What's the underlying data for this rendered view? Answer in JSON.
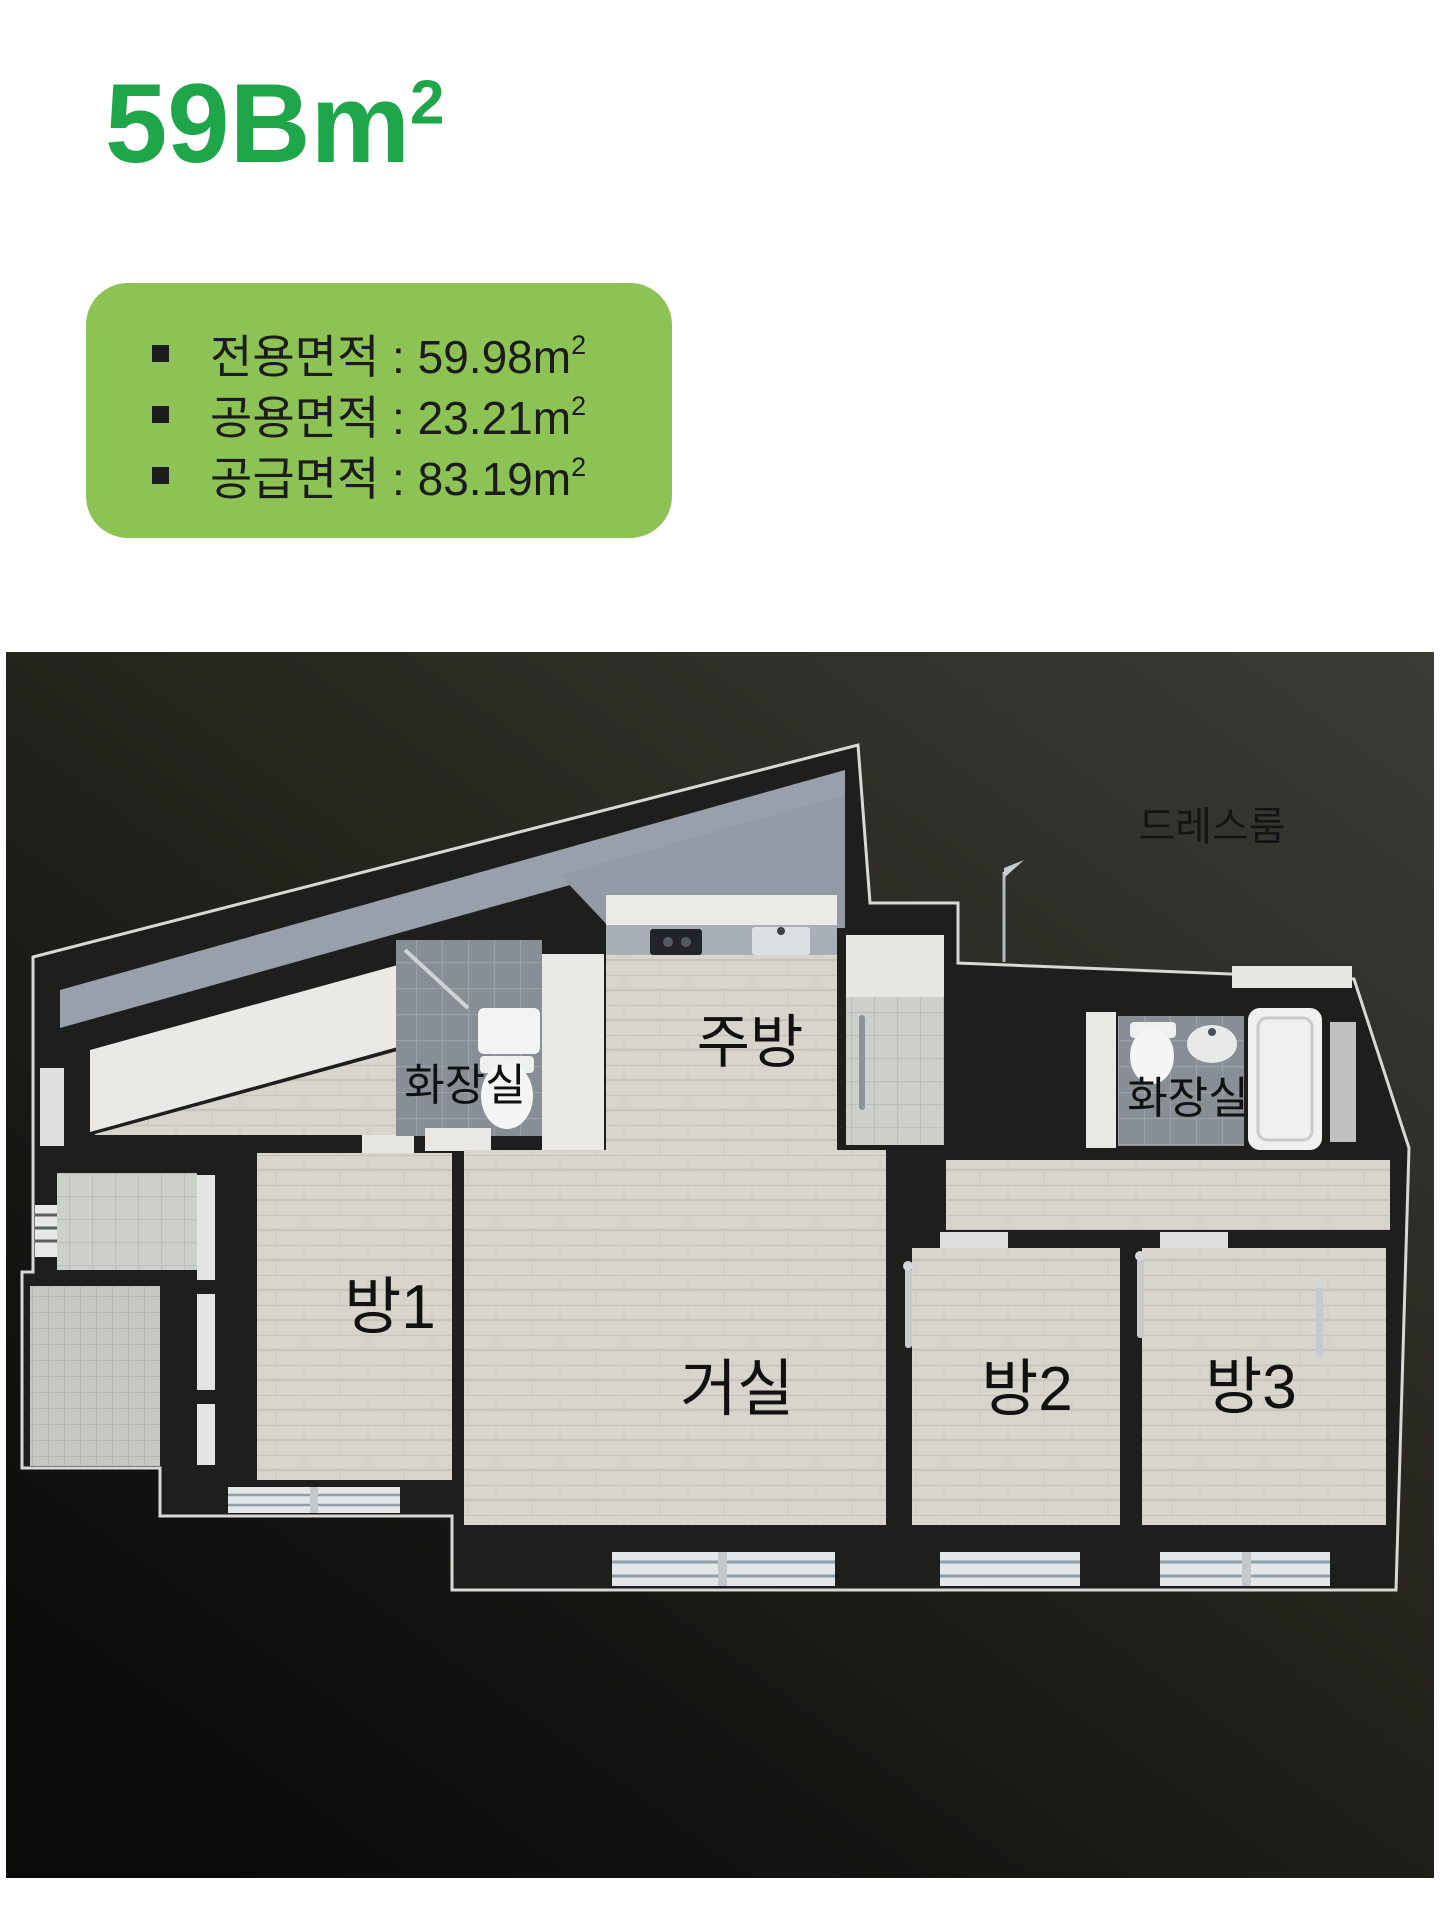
{
  "title": {
    "text": "59Bm",
    "sup": "2",
    "color": "#1fa64b"
  },
  "info_box": {
    "background": "#8dc254",
    "text_color": "#1c1c1c",
    "items": [
      {
        "text": "전용면적 : 59.98m",
        "sup": "2"
      },
      {
        "text": "공용면적 : 23.21m",
        "sup": "2"
      },
      {
        "text": "공급면적 : 83.19m",
        "sup": "2"
      }
    ]
  },
  "floor_plan": {
    "background_top": "#3c3c37",
    "background_bottom": "#0b0b0a",
    "wall_color": "#1e1e1d",
    "outline_color": "#d8d8d5",
    "wood_color": "#d8d5cd",
    "bath_tile_color": "#878e95",
    "balcony_tile_color": "#cdd0cb",
    "label_color": "#141414",
    "labels": {
      "dressroom": "드레스룸",
      "kitchen": "주방",
      "bath_left": "화장실",
      "bath_right": "화장실",
      "room1": "방1",
      "living": "거실",
      "room2": "방2",
      "room3": "방3"
    }
  }
}
